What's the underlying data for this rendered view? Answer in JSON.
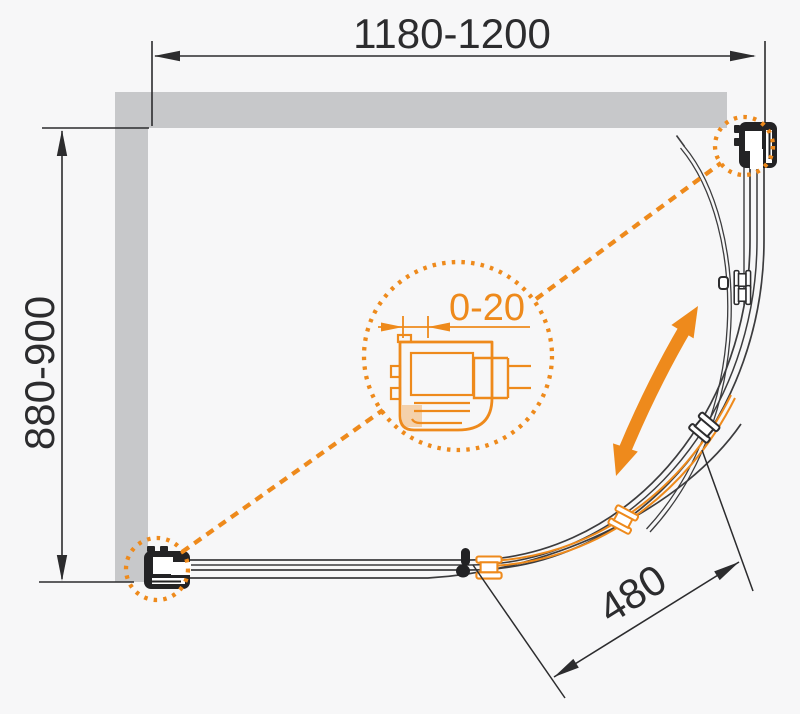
{
  "labels": {
    "width": "1180-1200",
    "depth": "880-900",
    "entry": "480",
    "adjust": "0-20"
  },
  "colors": {
    "accent": "#ee8a1c",
    "ink": "#2c2c2e",
    "wall": "#c7c8ca",
    "background": "#f7f7f8",
    "css": "--accent:#ee8a1c;--ink:#2c2c2e;--wall:#c7c8ca;--bg:#f7f7f8"
  }
}
